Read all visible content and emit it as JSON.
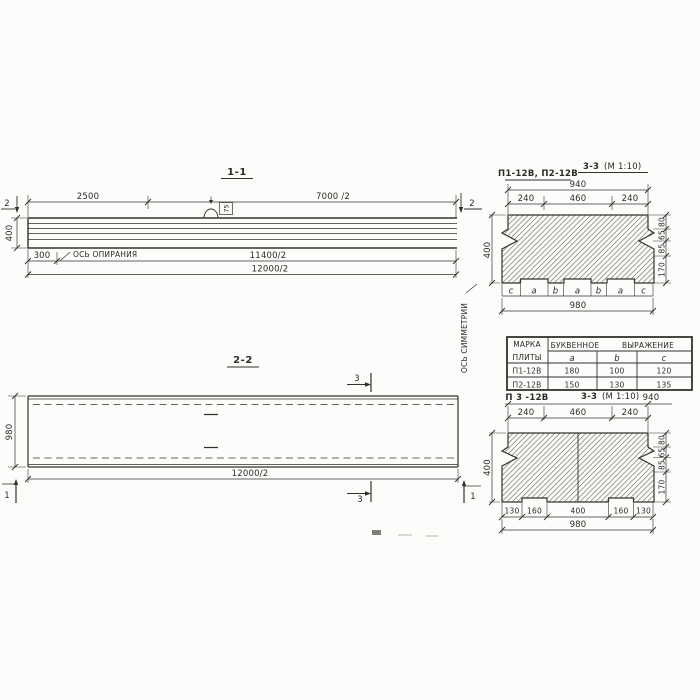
{
  "palette": {
    "bg": "#fcfcfb",
    "ink": "#32312d"
  },
  "v11": {
    "title": "1-1",
    "dim_2500": "2500",
    "dim_7000": "7000 /2",
    "marker2_left": "2",
    "marker2_right": "2",
    "dim_height": "400",
    "dim_300": "300",
    "support_label": "ОСЬ ОПИРАНИЯ",
    "hook_label": "75",
    "dim_11400": "11400/2",
    "dim_12000": "12000/2"
  },
  "v22": {
    "title": "2-2",
    "dim_980": "980",
    "dim_12000": "12000/2",
    "marker3_top": "3",
    "marker3_bottom": "3",
    "marker1_left": "1",
    "marker1_right": "1",
    "symmetry_label": "ОСЬ СИММЕТРИИ"
  },
  "s1": {
    "label": "П1-12В, П2-12В",
    "title": "3-3",
    "scale": "(М 1:10)",
    "dim_940": "940",
    "top_dims": [
      "240",
      "460",
      "240"
    ],
    "dim_400": "400",
    "right_dims": [
      "80",
      "65",
      "85",
      "170"
    ],
    "letters": [
      "c",
      "a",
      "b",
      "a",
      "b",
      "a",
      "c"
    ],
    "dim_980": "980"
  },
  "tb": {
    "h_mark_1": "МАРКА",
    "h_mark_2": "ПЛИТЫ",
    "h_expr_1": "БУКВЕННОЕ",
    "h_expr_2": "ВЫРАЖЕНИЕ",
    "cols": [
      "a",
      "b",
      "c"
    ],
    "rows": [
      {
        "mark": "П1-12В",
        "a": "180",
        "b": "100",
        "c": "120"
      },
      {
        "mark": "П2-12В",
        "a": "150",
        "b": "130",
        "c": "135"
      }
    ]
  },
  "s2": {
    "label": "П 3 -12В",
    "title": "3-3",
    "scale": "(М 1:10)",
    "dim_940": "940",
    "top_dims": [
      "240",
      "460",
      "240"
    ],
    "dim_400": "400",
    "right_dims": [
      "80",
      "65",
      "85",
      "170"
    ],
    "bottom_dims": [
      "130",
      "160",
      "400",
      "160",
      "130"
    ],
    "dim_980": "980"
  }
}
